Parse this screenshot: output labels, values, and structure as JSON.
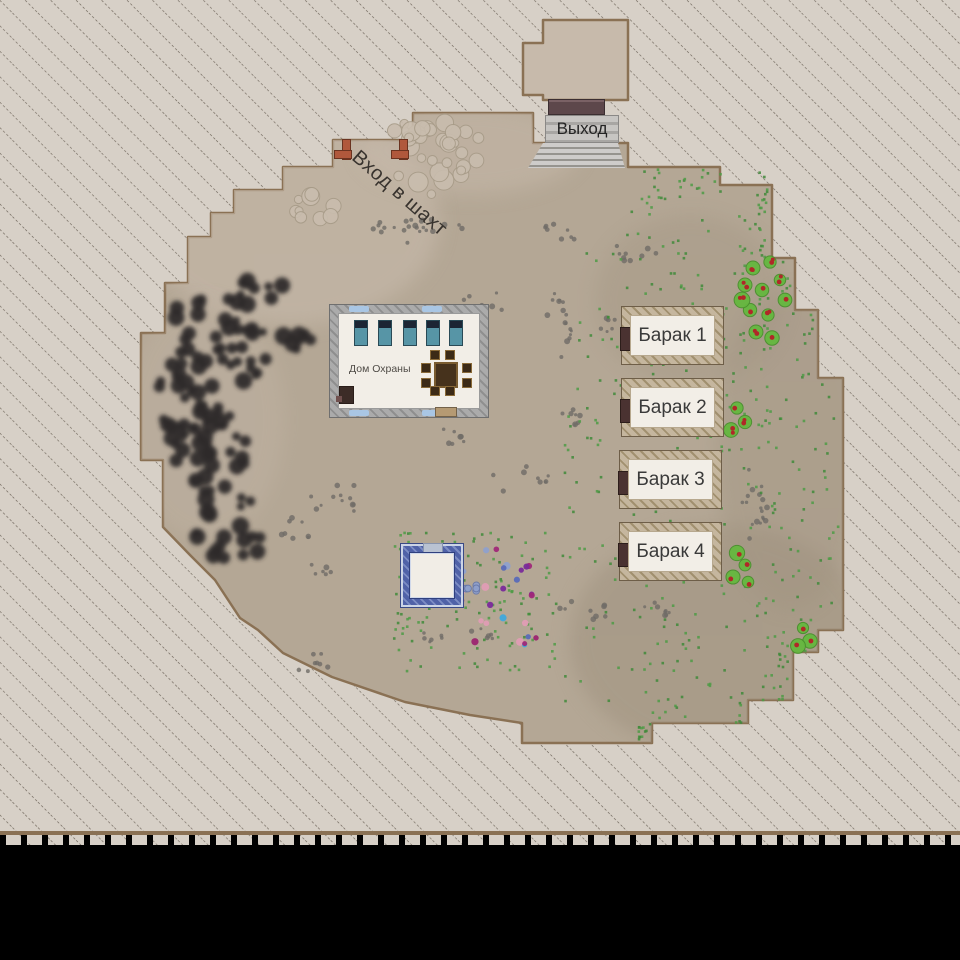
{
  "map": {
    "exit_label": "Выход",
    "mine_entrance_label": "Вход в шахт",
    "guard_house": {
      "label": "Дом Охраны"
    },
    "barracks": [
      {
        "label": "Барак 1"
      },
      {
        "label": "Барак 2"
      },
      {
        "label": "Барак 3"
      },
      {
        "label": "Барак 4"
      }
    ]
  },
  "colors": {
    "hatch_bg": "#d7d0c7",
    "hatch_line": "#6b6257",
    "terrain": "#b4a795",
    "terrain_border": "#8a7154",
    "terrain_light": "#c7baab",
    "terrain_dark": "#9e917e",
    "coal": "#2e2c2a",
    "stone": "#c9bdae",
    "pebble": "#6f6b66",
    "grass": "#4e9b45",
    "bush": "#65b83f",
    "berry": "#b02828",
    "guard_wall": "#9e9e9e",
    "barrack_wall": "#b2a184",
    "blue_wall": "#4a5aa4",
    "stairs": "#b7b5b2",
    "exit_door": "#5d474b",
    "gate_post": "#b0583c",
    "void": "#000000",
    "flower_palette": [
      "#3fa8dc",
      "#9c2470",
      "#e09cb4",
      "#5a6ab8",
      "#7a2a9a",
      "#8fa0cc",
      "#a02878"
    ]
  }
}
